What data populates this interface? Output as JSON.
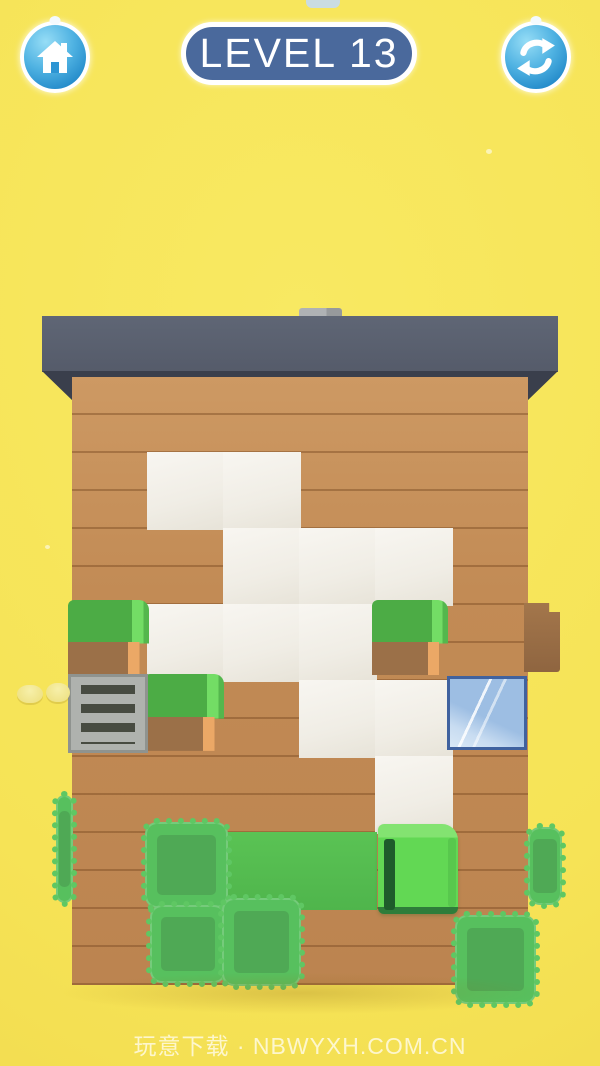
{
  "app": {
    "background_color": "#F6E356",
    "colors": {
      "roof": "#565C6B",
      "wall_wood": "#C28B55",
      "paint_white": "#F2EFE8",
      "paint_green": "#55BE52",
      "bush_green": "#4CAC45",
      "hedge_green": "#57C05E",
      "cube_green": "#62D854",
      "button_blue": "#1E86C7",
      "badge_blue": "#4A699C",
      "window_glass": "#A6C4E6"
    }
  },
  "header": {
    "home_button": {
      "icon": "home-icon"
    },
    "level_badge": {
      "label": "LEVEL 13"
    },
    "restart_button": {
      "icon": "refresh-icon"
    }
  },
  "watermark": {
    "text": "玩意下载 · NBWYXH.COM.CN"
  },
  "board": {
    "grid": {
      "origin_x": 72,
      "origin_y": 377,
      "cell": 76,
      "cols": 6,
      "rows": 8
    },
    "white_cells": [
      [
        1,
        1
      ],
      [
        2,
        1
      ],
      [
        2,
        2
      ],
      [
        3,
        2
      ],
      [
        4,
        2
      ],
      [
        1,
        3
      ],
      [
        2,
        3
      ],
      [
        3,
        3
      ],
      [
        3,
        4
      ],
      [
        4,
        4
      ],
      [
        4,
        5
      ]
    ],
    "green_cells": [
      [
        2,
        6
      ],
      [
        3,
        6
      ]
    ],
    "objects": [
      {
        "type": "bush",
        "name": "tree-bush",
        "x": 68,
        "y": 600,
        "w": 81,
        "h": 75
      },
      {
        "type": "bush",
        "name": "tree-bush",
        "x": 144,
        "y": 674,
        "w": 80,
        "h": 77
      },
      {
        "type": "bush",
        "name": "tree-bush",
        "x": 372,
        "y": 600,
        "w": 76,
        "h": 75
      },
      {
        "type": "grate",
        "name": "vent-grate",
        "x": 68,
        "y": 674,
        "w": 80,
        "h": 79
      },
      {
        "type": "window",
        "name": "glass-window",
        "x": 447,
        "y": 676,
        "w": 80,
        "h": 74
      },
      {
        "type": "block",
        "name": "wood-block",
        "x": 524,
        "y": 603,
        "w": 36,
        "h": 69
      },
      {
        "type": "hedge",
        "name": "hedge-block",
        "x": 56,
        "y": 795,
        "w": 17,
        "h": 108
      },
      {
        "type": "hedge",
        "name": "hedge-block",
        "x": 528,
        "y": 827,
        "w": 34,
        "h": 78
      },
      {
        "type": "hedge",
        "name": "hedge-block",
        "x": 145,
        "y": 822,
        "w": 83,
        "h": 86
      },
      {
        "type": "hedge",
        "name": "hedge-block",
        "x": 150,
        "y": 905,
        "w": 76,
        "h": 78
      },
      {
        "type": "hedge",
        "name": "hedge-block",
        "x": 222,
        "y": 898,
        "w": 79,
        "h": 88
      },
      {
        "type": "hedge",
        "name": "hedge-block",
        "x": 455,
        "y": 915,
        "w": 81,
        "h": 89
      },
      {
        "type": "cube",
        "name": "paint-roller-cube",
        "x": 378,
        "y": 824,
        "w": 80,
        "h": 90,
        "interactable": true
      },
      {
        "type": "coin",
        "name": "coin",
        "x": 17,
        "y": 685,
        "w": 26,
        "h": 18
      },
      {
        "type": "coin",
        "name": "coin",
        "x": 46,
        "y": 683,
        "w": 24,
        "h": 19
      }
    ]
  }
}
